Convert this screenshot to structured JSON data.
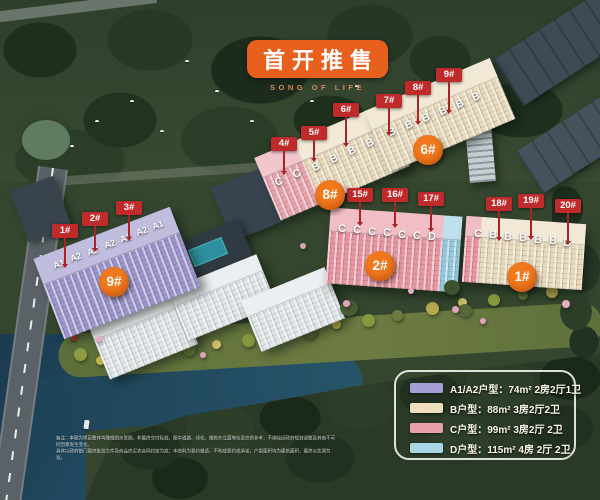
{
  "title": {
    "text": "首开推售",
    "subtitle": "SONG OF LIFE"
  },
  "colors": {
    "accent_orange": "#e8601d",
    "flag_red": "#bf2a2b",
    "circle_orange": "#f0791e",
    "type_a_purple": "#a49fd4",
    "type_b_cream": "#eee0be",
    "type_c_pink": "#e8a0a8",
    "type_d_blue": "#abd6e6"
  },
  "buildings": [
    {
      "id": "9#",
      "flags": [
        "1#",
        "2#",
        "3#"
      ],
      "roof_labels": [
        "A1",
        "A2",
        "A2",
        "A2",
        "A2",
        "A2",
        "A1"
      ]
    },
    {
      "id": "8#",
      "flags": [
        "4#",
        "5#",
        "6#"
      ],
      "roof_labels": [
        "C",
        "C",
        "B",
        "B",
        "B",
        "B"
      ]
    },
    {
      "id": "6#",
      "flags": [
        "7#",
        "8#",
        "9#"
      ],
      "roof_labels": [
        "B",
        "B",
        "B",
        "B",
        "B",
        "B"
      ]
    },
    {
      "id": "2#",
      "flags": [
        "15#",
        "16#",
        "17#"
      ],
      "roof_labels": [
        "C",
        "C",
        "C",
        "C",
        "C",
        "C",
        "D"
      ]
    },
    {
      "id": "1#",
      "flags": [
        "18#",
        "19#",
        "20#"
      ],
      "roof_labels": [
        "C",
        "B",
        "B",
        "B",
        "B",
        "B",
        "B"
      ]
    }
  ],
  "legend": {
    "items": [
      {
        "type": "A1/A2",
        "swatch_color": "#a49fd4",
        "label": "A1/A2户型：74m² 2房2厅1卫"
      },
      {
        "type": "B",
        "swatch_color": "#eee0be",
        "label": "B户型：88m² 3房2厅2卫"
      },
      {
        "type": "C",
        "swatch_color": "#e8a0a8",
        "label": "C户型：99m² 3房2厅 2卫"
      },
      {
        "type": "D",
        "swatch_color": "#abd6e6",
        "label": "D户型：115m² 4房 2厅 2卫"
      }
    ]
  },
  "disclaimer": {
    "line1": "备注：本图为项目整体鸟瞰规划示意图，非最终交付标准，图中道路、绿化、楼栋外立面等信息仅供参考，不排除因政府规划调整及其他不可控因素发生变化。",
    "line2": "具体以政府部门最终批准文件及商品房买卖合同约定为准；本资料为要约邀请，不构成要约或承诺，户型面积均为建筑面积，最终以实测为准。"
  }
}
